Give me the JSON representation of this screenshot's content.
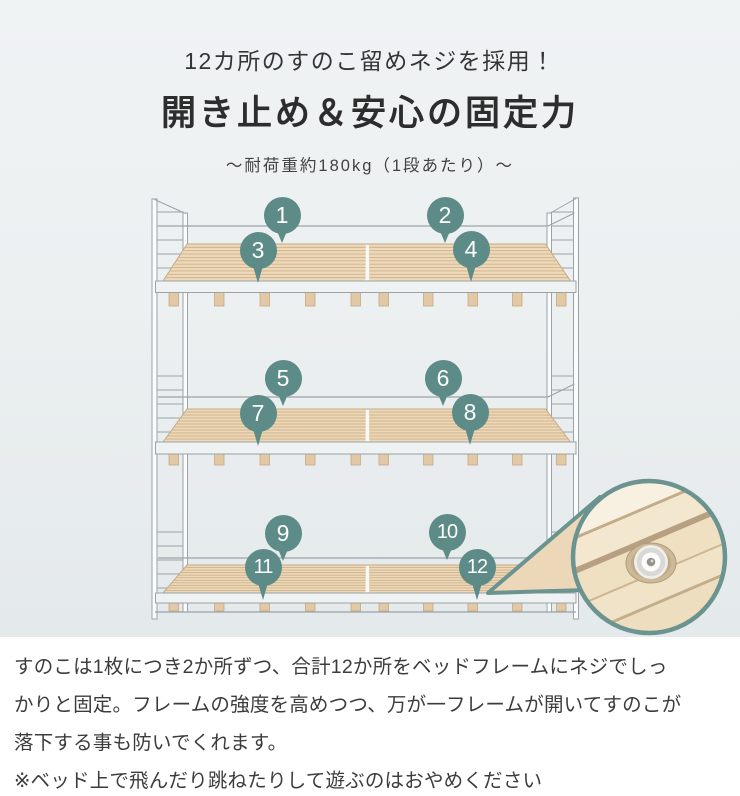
{
  "header": {
    "small_title": "12カ所のすのこ留めネジを採用！",
    "title": "開き止め＆安心の固定力",
    "capacity_note": "〜耐荷重約180kg（1段あたり）〜"
  },
  "diagram": {
    "markers": [
      "1",
      "2",
      "3",
      "4",
      "5",
      "6",
      "7",
      "8",
      "9",
      "10",
      "11",
      "12"
    ]
  },
  "footer": {
    "body_lines": [
      "すのこは1枚につき2か所ずつ、合計12か所をベッドフレームにネジでしっ",
      "かりと固定。フレームの強度を高めつつ、万が一フレームが開いてすのこが",
      "落下する事も防いでくれます。"
    ],
    "note": "※ベッド上で飛んだり跳ねたりして遊ぶのはおやめください"
  },
  "colors": {
    "accent": "#5d8b87",
    "magnifier_border": "#6b9390",
    "frame_line": "#9ba3a7",
    "wood": "#edd9b9",
    "wood_line": "#cfb28b",
    "wood_edge": "#c5a983",
    "band_fill": "#eff2f2",
    "foot_wood": "#e2c8a4",
    "inset_wood": "#f2e5cc",
    "text": "#3c3c3c",
    "bg_top": "#f0f3f4",
    "bg_bottom": "#e4e9eb",
    "panel": "#ffffff"
  }
}
